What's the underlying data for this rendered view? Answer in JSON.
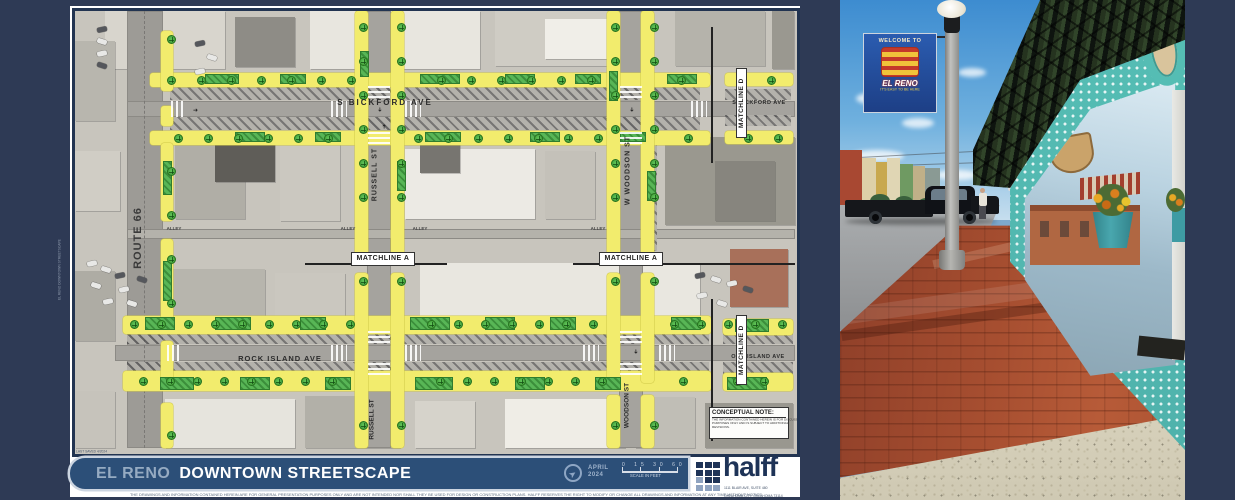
{
  "plan": {
    "title": {
      "left": "EL RENO",
      "right": "DOWNTOWN STREETSCAPE"
    },
    "date": {
      "month": "APRIL",
      "year": "2024"
    },
    "scale": {
      "ticks": [
        "0",
        "15",
        "30",
        "60"
      ],
      "ticks_text": "0  15  30  60",
      "label": "SCALE IN FEET"
    },
    "logo": {
      "name": "halff",
      "address_lines": [
        "1111 BLAIR AVE, SUITE 480",
        "OKLAHOMA CITY, OKLAHOMA 73114",
        "TEL (405) 348-3800"
      ]
    },
    "plot_stamp": "LAST SAVED 4/2024",
    "file_stamp": "EL RENO DOWNTOWN STREETSCAPE",
    "disclaimer": "THE DRAWINGS AND INFORMATION CONTAINED HEREIN ARE FOR GENERAL PRESENTATION PURPOSES ONLY AND ARE NOT INTENDED NOR SHALL THEY BE USED FOR DESIGN OR CONSTRUCTION PLANS. HALFF RESERVES THE RIGHT TO MODIFY OR CHANGE ALL DRAWINGS AND INFORMATION AT ANY TIME WITHOUT NOTICE.",
    "labels": {
      "route_66": "ROUTE 66",
      "russell_st": "RUSSELL ST",
      "w_woodson_st": "W WOODSON ST",
      "woodson_st": "WOODSON ST",
      "s_bickford_ave": "S BICKFORD AVE",
      "s_bickford_ave_right": "S BICKFORD AVE",
      "rock_island_ave": "ROCK ISLAND AVE",
      "rock_island_ave_right": "OCK ISLAND AVE",
      "matchline_a": "MATCHLINE A",
      "matchline_d": "MATCHLINE D",
      "alley": "ALLEY"
    },
    "conceptual_note": {
      "title": "CONCEPTUAL NOTE:",
      "body": "THE INFORMATION CONTAINED HEREIN IS FOR DISCUSSION PURPOSES ONLY AND IS SUBJECT TO ADDITIONAL REVISIONS."
    }
  },
  "photo": {
    "banner": {
      "line1": "WELCOME TO",
      "line2": "EL RENO",
      "line3": "IT'S EASY TO BE HERE"
    }
  },
  "colors": {
    "background_navy": "#2e3a55",
    "titlebar_navy": "#2c4f78",
    "logo_navy": "#1e3357",
    "highlight_yellow": "#f2ec6d",
    "tree_green": "#4fae47",
    "banner_blue": "#2b5cb0",
    "brick_red": "#a64e30",
    "storefront_teal": "#55bdb4"
  }
}
